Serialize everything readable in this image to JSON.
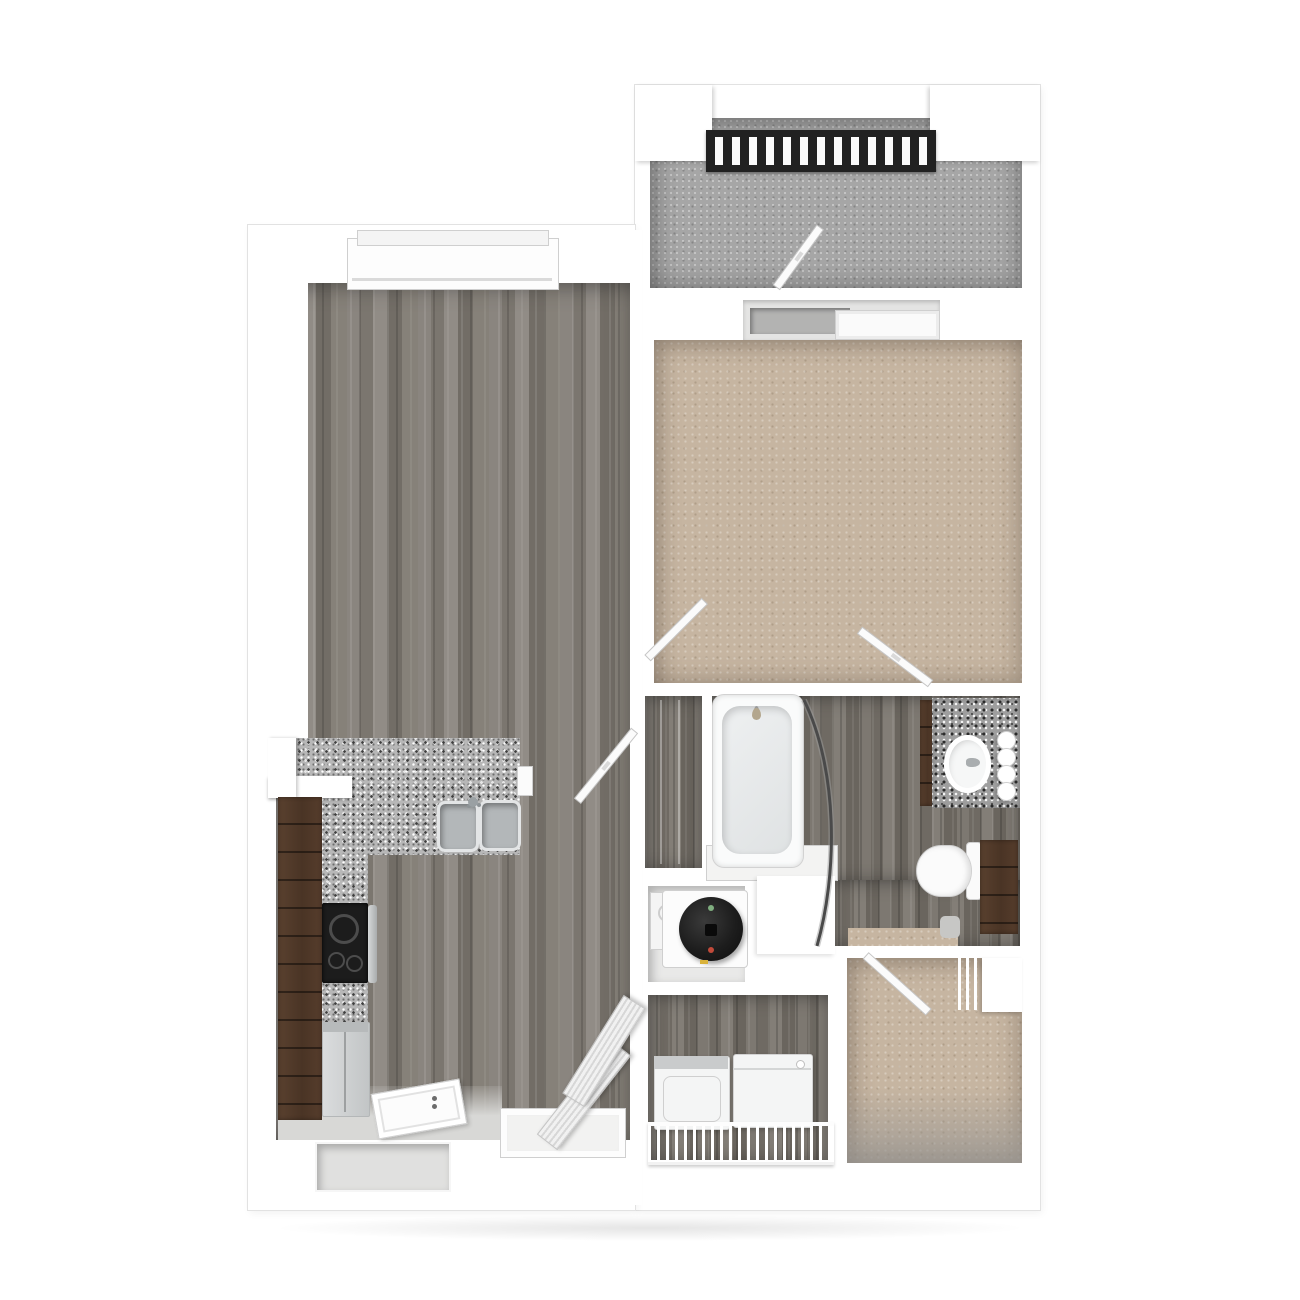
{
  "description": "3D top-down rendered floor plan of a one-bedroom, one-bath apartment with balcony, no text labels",
  "colors": {
    "wall": "#ffffff",
    "wall_edge": "#dedede",
    "wood": "#847f79",
    "wood_dark": "#78736c",
    "carpet": "#c6b5a1",
    "concrete": "#a6a6a6",
    "granite_light": "#b7b7b7",
    "granite_dark": "#9e9e9e",
    "cabinet": "#4e3728",
    "appliance_white": "#f2f3f4",
    "stainless": "#c3c6c8",
    "railing": "#212121",
    "stove": "#1c1c1c",
    "water_heater": "#1d1d1d"
  },
  "rooms": [
    {
      "id": "balcony",
      "floor": "concrete",
      "features": [
        "metal-railing",
        "hinged-patio-door"
      ]
    },
    {
      "id": "bedroom",
      "floor": "carpet",
      "features": [
        "sliding-glass-door",
        "entry-door",
        "bathroom-door"
      ]
    },
    {
      "id": "living-room",
      "floor": "wood-plank",
      "features": [
        "window",
        "entry-door",
        "storage-closet-door",
        "bifold-louvered-doors"
      ]
    },
    {
      "id": "kitchen",
      "floor": "wood-plank",
      "features": [
        "l-shaped-granite-counter",
        "double-sink",
        "range",
        "refrigerator",
        "tall-cabinets",
        "half-wall"
      ]
    },
    {
      "id": "bathroom",
      "floor": "wood-plank",
      "features": [
        "bathtub",
        "curved-shower-rod",
        "granite-vanity",
        "oval-sink",
        "vanity-lights",
        "toilet",
        "storage-cabinet"
      ]
    },
    {
      "id": "linen-closet",
      "floor": "wood-plank",
      "features": [
        "shelves"
      ]
    },
    {
      "id": "water-heater-closet",
      "floor": "white-pan",
      "features": [
        "cylindrical-water-heater"
      ]
    },
    {
      "id": "laundry-closet",
      "floor": "wood-plank",
      "features": [
        "washer",
        "dryer",
        "wire-shelf"
      ]
    },
    {
      "id": "walk-in-closet",
      "floor": "carpet",
      "features": [
        "wire-shelving",
        "corner-shelf",
        "hinged-door"
      ]
    }
  ]
}
